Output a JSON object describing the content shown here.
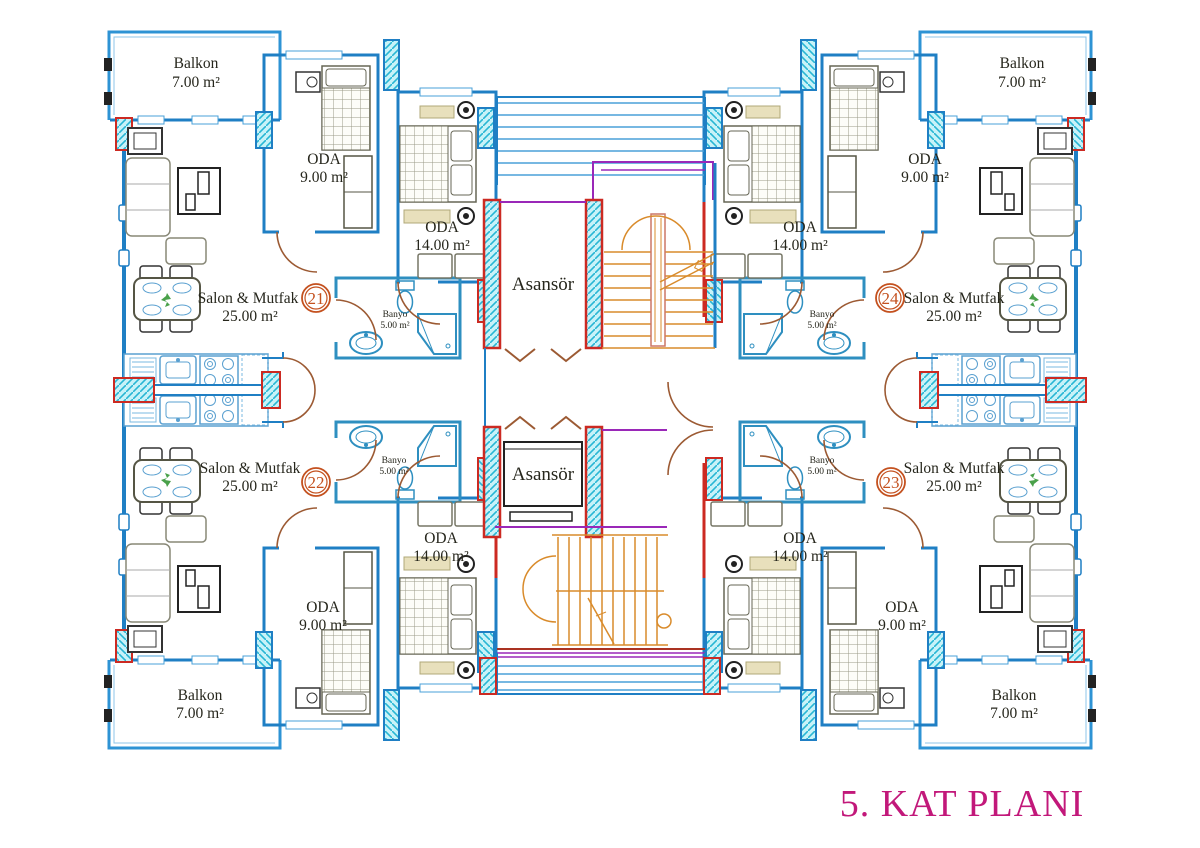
{
  "title": "5. KAT PLANI",
  "core": {
    "elevator_top_label": "Asansör",
    "elevator_bottom_label": "Asansör"
  },
  "apartments": [
    {
      "number": "21",
      "position": "top-left",
      "balkon": {
        "name": "Balkon",
        "area": "7.00 m²"
      },
      "oda_small": {
        "name": "ODA",
        "area": "9.00 m²"
      },
      "oda_large": {
        "name": "ODA",
        "area": "14.00 m²"
      },
      "salon": {
        "name": "Salon & Mutfak",
        "area": "25.00 m²"
      },
      "banyo": {
        "name": "Banyo",
        "area": "5.00 m²"
      }
    },
    {
      "number": "22",
      "position": "bottom-left",
      "balkon": {
        "name": "Balkon",
        "area": "7.00 m²"
      },
      "oda_small": {
        "name": "ODA",
        "area": "9.00 m²"
      },
      "oda_large": {
        "name": "ODA",
        "area": "14.00 m²"
      },
      "salon": {
        "name": "Salon & Mutfak",
        "area": "25.00 m²"
      },
      "banyo": {
        "name": "Banyo",
        "area": "5.00 m²"
      }
    },
    {
      "number": "23",
      "position": "bottom-right",
      "balkon": {
        "name": "Balkon",
        "area": "7.00 m²"
      },
      "oda_small": {
        "name": "ODA",
        "area": "9.00 m²"
      },
      "oda_large": {
        "name": "ODA",
        "area": "14.00 m²"
      },
      "salon": {
        "name": "Salon & Mutfak",
        "area": "25.00 m²"
      },
      "banyo": {
        "name": "Banyo",
        "area": "5.00 m²"
      }
    },
    {
      "number": "24",
      "position": "top-right",
      "balkon": {
        "name": "Balkon",
        "area": "7.00 m²"
      },
      "oda_small": {
        "name": "ODA",
        "area": "9.00 m²"
      },
      "oda_large": {
        "name": "ODA",
        "area": "14.00 m²"
      },
      "salon": {
        "name": "Salon & Mutfak",
        "area": "25.00 m²"
      },
      "banyo": {
        "name": "Banyo",
        "area": "5.00 m²"
      }
    }
  ],
  "colors": {
    "wall_blue": "#1f7fc4",
    "light_blue": "#5aa0d0",
    "hatch_cyan": "#bff0f6",
    "hatch_line": "#28b6d4",
    "accent_red": "#cc2a22",
    "stair_orange": "#d98b2b",
    "purple": "#9a28b8",
    "door_brown": "#9c5a33",
    "title_magenta": "#c2187a",
    "number_orange": "#c4511f",
    "plant_green": "#4aa14a"
  }
}
